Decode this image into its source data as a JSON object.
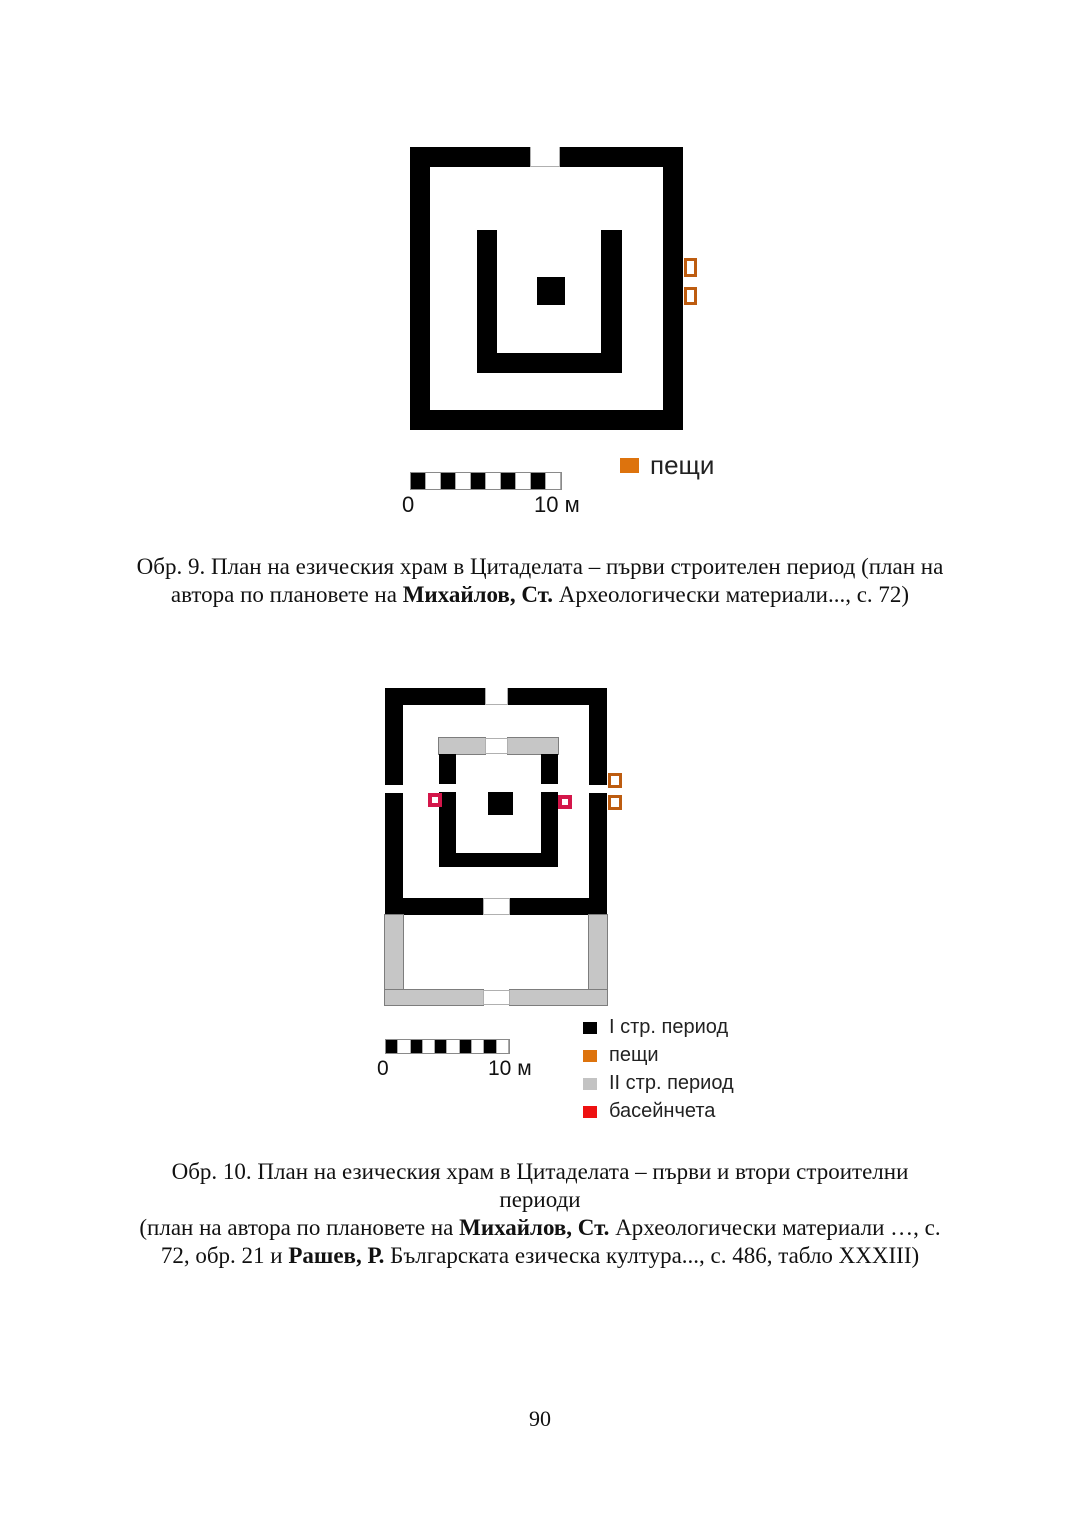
{
  "page": {
    "number": "90"
  },
  "fig9": {
    "caption": {
      "line1": "Обр. 9. План на езическия храм в Цитаделата – първи строителен период (план на",
      "line2_pre": "автора по плановете на ",
      "line2_bold": "Михайлов, Ст.",
      "line2_post": " Археологически материали..., с. 72)"
    },
    "scalebar": {
      "start": "0",
      "end": "10 м"
    },
    "legend": {
      "items": [
        {
          "label": "пещи",
          "color": "#dd730d"
        }
      ]
    }
  },
  "fig10": {
    "caption": {
      "line1": "Обр. 10. План на езическия храм в Цитаделата – първи и втори строителни периоди",
      "line2_pre": "(план на автора по плановете на  ",
      "line2_bold": "Михайлов, Ст.",
      "line2_post": " Археологически материали …, с.",
      "line3_pre": "72, обр. 21 и ",
      "line3_bold": "Рашев, Р.",
      "line3_post": " Българската езическа култура..., с. 486, табло XXXIII)"
    },
    "scalebar": {
      "start": "0",
      "end": "10 м"
    },
    "legend": {
      "items": [
        {
          "label": "I стр. период",
          "color": "#000000"
        },
        {
          "label": "пещи",
          "color": "#dd730d"
        },
        {
          "label": "II стр. период",
          "color": "#c3c3c3"
        },
        {
          "label": "басейнчета",
          "color": "#ee1111"
        }
      ]
    }
  },
  "colors": {
    "wall_period1": "#000000",
    "wall_period2": "#c6c6c6",
    "oven_outline": "#bd5c10",
    "basin_outline": "#d4164a"
  }
}
